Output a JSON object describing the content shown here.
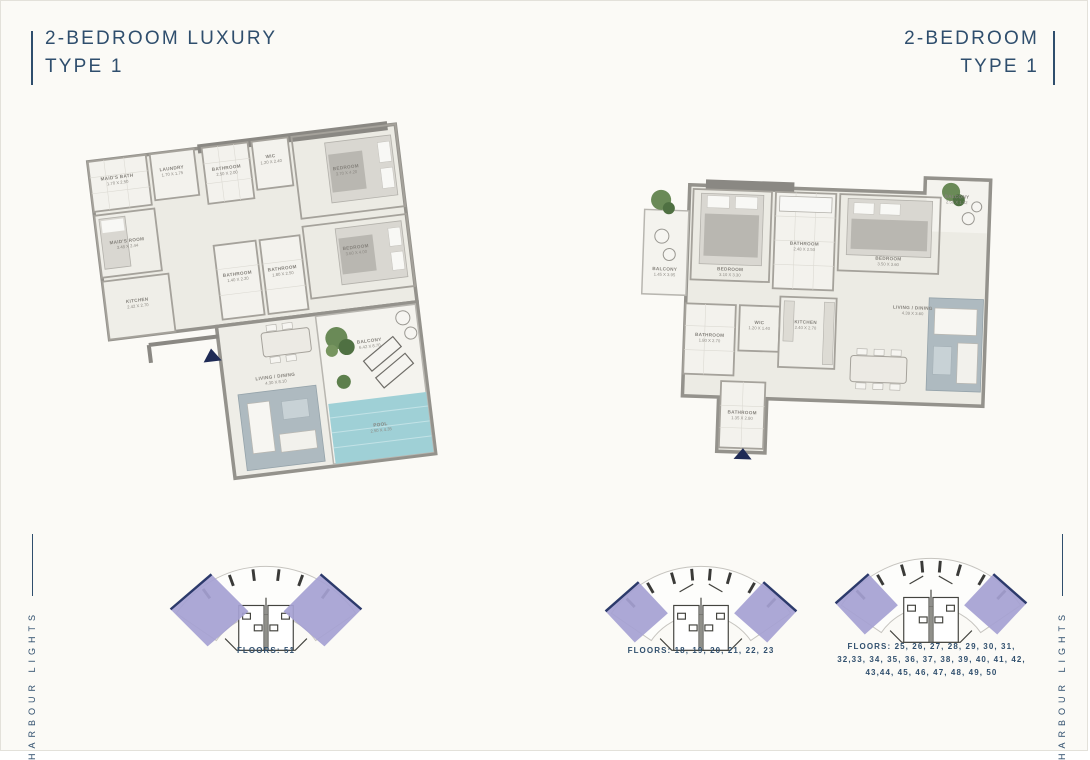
{
  "titles": {
    "left": {
      "line1": "2-BEDROOM LUXURY",
      "line2": "TYPE 1"
    },
    "right": {
      "line1": "2-BEDROOM",
      "line2": "TYPE 1"
    }
  },
  "brand": {
    "left": "HARBOUR LIGHTS",
    "right": "HARBOUR LIGHTS"
  },
  "colors": {
    "navy": "#2f4e6d",
    "arrow_navy": "#1e2a55",
    "keyplan_purple": "#a5a1d3",
    "pool_teal": "#9fd0d6",
    "wall_gray": "#94928c"
  },
  "plan_left": {
    "name": "2-Bedroom Luxury Type 1",
    "rooms": [
      {
        "label": "MAID'S BATH",
        "dim": "1.70 X 2.50"
      },
      {
        "label": "LAUNDRY",
        "dim": "1.70 X 1.75"
      },
      {
        "label": "MAID'S ROOM",
        "dim": "3.48 X 2.44"
      },
      {
        "label": "BATHROOM",
        "dim": "2.50 X 2.00"
      },
      {
        "label": "WIC",
        "dim": "1.20 X 2.40"
      },
      {
        "label": "BEDROOM",
        "dim": "3.70 X 4.20"
      },
      {
        "label": "BEDROOM",
        "dim": "3.60 X 4.00"
      },
      {
        "label": "KITCHEN",
        "dim": "2.42 X 2.70"
      },
      {
        "label": "BATHROOM",
        "dim": "1.40 X 2.20"
      },
      {
        "label": "BATHROOM",
        "dim": "1.80 X 2.50"
      },
      {
        "label": "LIVING / DINING",
        "dim": "4.30 X 8.10"
      },
      {
        "label": "BALCONY",
        "dim": "6.42 X 8.70"
      },
      {
        "label": "POOL",
        "dim": "2.50 X 4.35"
      }
    ]
  },
  "plan_right": {
    "name": "2-Bedroom Type 1",
    "rooms": [
      {
        "label": "BALCONY",
        "dim": "1.45 X 3.95"
      },
      {
        "label": "BEDROOM",
        "dim": "3.10 X 3.30"
      },
      {
        "label": "BATHROOM",
        "dim": "2.48 X 2.50"
      },
      {
        "label": "BEDROOM",
        "dim": "3.50 X 3.60"
      },
      {
        "label": "BALCONY",
        "dim": "2.50 X 1.32"
      },
      {
        "label": "BATHROOM",
        "dim": "1.80 X 2.70"
      },
      {
        "label": "WIC",
        "dim": "1.20 X 1.40"
      },
      {
        "label": "KITCHEN",
        "dim": "2.40 X 2.70"
      },
      {
        "label": "LIVING / DINING",
        "dim": "4.39 X 3.60"
      },
      {
        "label": "BATHROOM",
        "dim": "1.35 X 2.80"
      }
    ]
  },
  "keyplans": [
    {
      "caption": "FLOORS: 51"
    },
    {
      "caption": "FLOORS: 18, 19, 20, 21, 22, 23"
    },
    {
      "caption": "FLOORS: 25, 26, 27, 28, 29, 30, 31, 32,33, 34, 35, 36, 37, 38, 39, 40, 41, 42, 43,44, 45, 46, 47, 48, 49, 50"
    }
  ]
}
